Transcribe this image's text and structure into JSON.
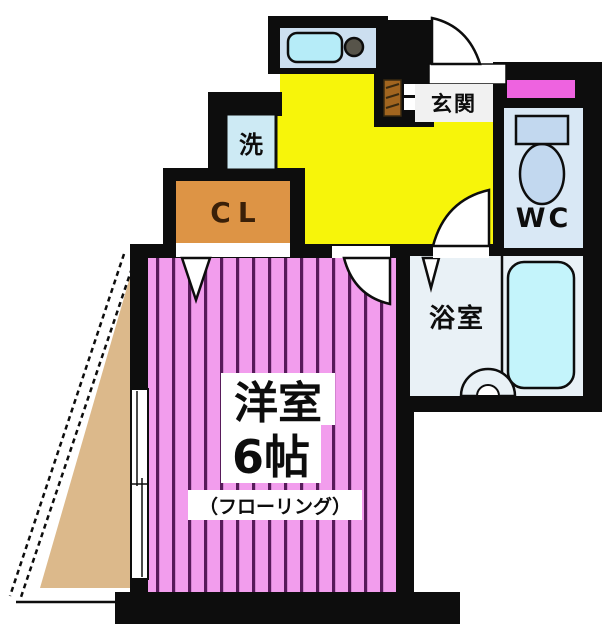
{
  "plan_title": "apartment-floor-plan",
  "rooms": {
    "main_room": {
      "name": "洋室",
      "size": "6帖",
      "floor_note": "（フローリング）",
      "floor_color": "#f29ded",
      "stripe_color": "#571a5a"
    },
    "closet": {
      "label": "CL",
      "color": "#dd9445"
    },
    "washer": {
      "label": "洗",
      "color": "#cdeaf4"
    },
    "entrance": {
      "label": "玄関",
      "floor_color": "#f7f50a"
    },
    "toilet": {
      "label": "WC",
      "color": "#d9e8f5",
      "window_color": "#ee63e0"
    },
    "bathroom": {
      "label": "浴室",
      "color": "#e9f1f6",
      "tub_color": "#c4f4fb"
    },
    "balcony": {
      "color": "#dcb98b"
    }
  },
  "palette": {
    "wall": "#0d0d0d",
    "kitchen_floor": "#f7f50a",
    "counter": "#ccdff0",
    "sink": "#b6ecf8",
    "door_fill": "#ffffff"
  }
}
